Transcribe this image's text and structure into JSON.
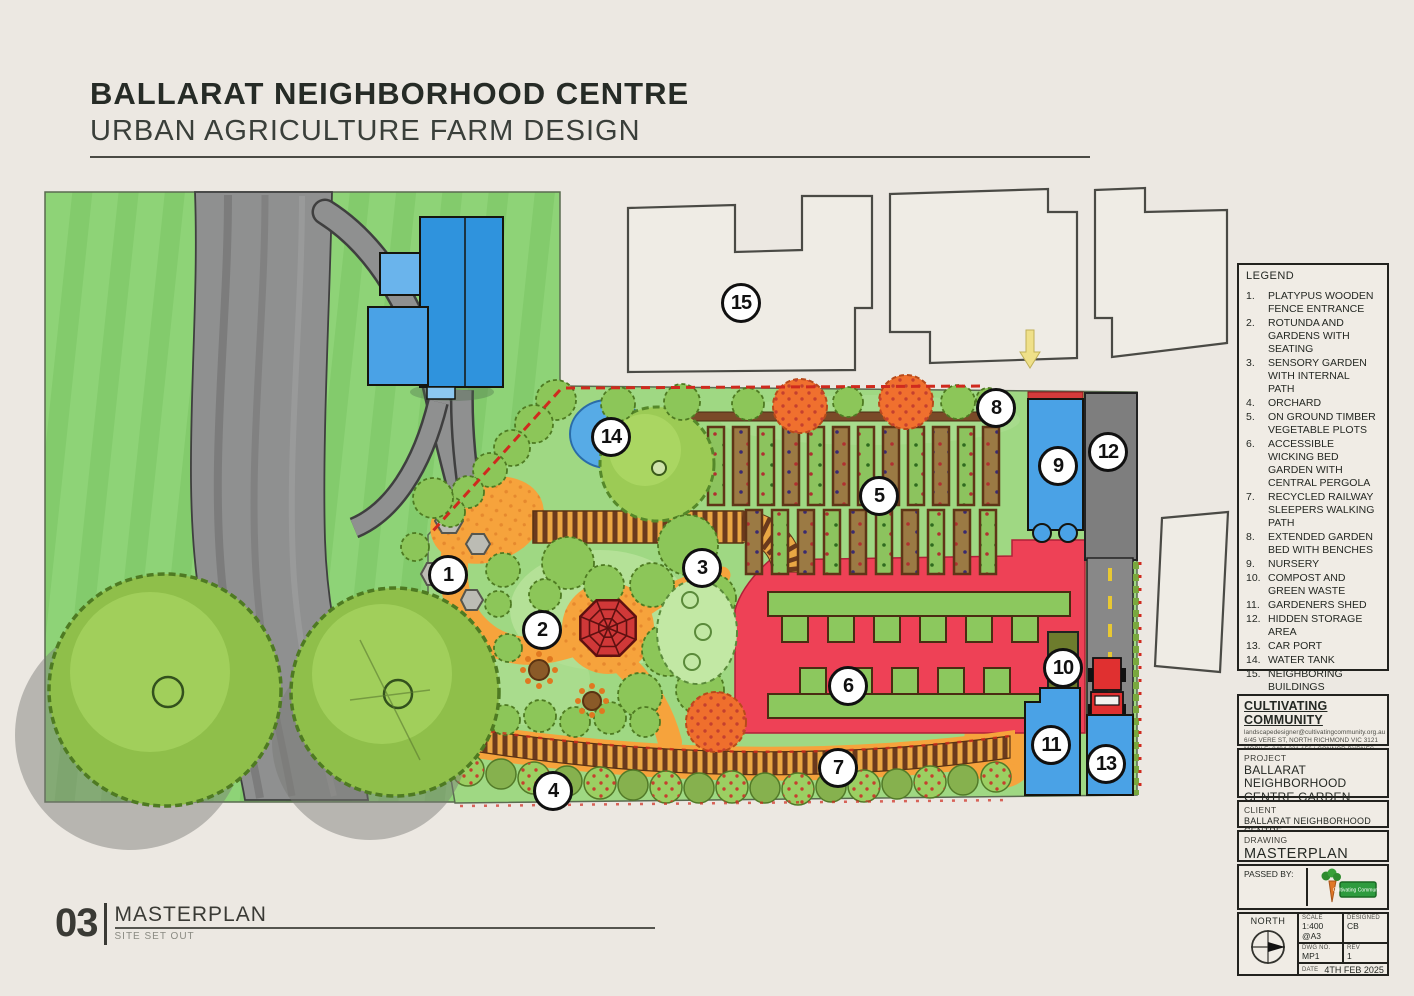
{
  "header": {
    "title_line1": "BALLARAT NEIGHBORHOOD CENTRE",
    "title_line2": "URBAN AGRICULTURE FARM DESIGN"
  },
  "drawing_label": {
    "number": "03",
    "title": "MASTERPLAN",
    "subtitle": "SITE SET OUT"
  },
  "legend": {
    "title": "LEGEND",
    "items": [
      {
        "num": "1.",
        "text": "PLATYPUS WOODEN FENCE ENTRANCE"
      },
      {
        "num": "2.",
        "text": "ROTUNDA AND GARDENS WITH SEATING"
      },
      {
        "num": "3.",
        "text": "SENSORY GARDEN WITH INTERNAL PATH"
      },
      {
        "num": "4.",
        "text": "ORCHARD"
      },
      {
        "num": "5.",
        "text": "ON GROUND TIMBER VEGETABLE PLOTS"
      },
      {
        "num": "6.",
        "text": "ACCESSIBLE WICKING BED GARDEN WITH CENTRAL PERGOLA"
      },
      {
        "num": "7.",
        "text": "RECYCLED RAILWAY SLEEPERS WALKING PATH"
      },
      {
        "num": "8.",
        "text": "EXTENDED GARDEN BED WITH BENCHES"
      },
      {
        "num": "9.",
        "text": "NURSERY"
      },
      {
        "num": "10.",
        "text": "COMPOST AND GREEN WASTE"
      },
      {
        "num": "11.",
        "text": "GARDENERS SHED"
      },
      {
        "num": "12.",
        "text": "HIDDEN STORAGE AREA"
      },
      {
        "num": "13.",
        "text": "CAR PORT"
      },
      {
        "num": "14.",
        "text": "WATER TANK"
      },
      {
        "num": "15.",
        "text": "NEIGHBORING BUILDINGS"
      }
    ]
  },
  "markers": [
    {
      "number": "1"
    },
    {
      "number": "2"
    },
    {
      "number": "3"
    },
    {
      "number": "4"
    },
    {
      "number": "5"
    },
    {
      "number": "6"
    },
    {
      "number": "7"
    },
    {
      "number": "8"
    },
    {
      "number": "9"
    },
    {
      "number": "10"
    },
    {
      "number": "11"
    },
    {
      "number": "12"
    },
    {
      "number": "13"
    },
    {
      "number": "14"
    },
    {
      "number": "15"
    }
  ],
  "title_block": {
    "company": {
      "name": "CULTIVATING COMMUNITY",
      "email": "landscapedesigner@cultivatingcommunity.org.au",
      "address": "6/45 VERE ST, NORTH RICHMOND VIC 3121",
      "phone": "MOBILE: 0404 221 156 | CONNOR BYRNES"
    },
    "project": {
      "label": "PROJECT",
      "value": "BALLARAT NEIGHBORHOOD CENTRE GARDEN BUILD"
    },
    "client": {
      "label": "CLIENT",
      "value": "BALLARAT NEIGHBORHOOD CENTRE"
    },
    "drawing": {
      "label": "DRAWING",
      "value": "MASTERPLAN"
    },
    "passed_by_label": "PASSED BY:",
    "logo_text": "Cultivating Community",
    "north_label": "NORTH",
    "scale": {
      "label": "SCALE",
      "value": "1:400 @A3"
    },
    "designed": {
      "label": "DESIGNED",
      "value": "CB"
    },
    "dwg_no": {
      "label": "DWG NO.",
      "value": "MP1"
    },
    "rev": {
      "label": "REV",
      "value": "1"
    },
    "date": {
      "label": "DATE",
      "value": "4TH FEB 2025"
    }
  },
  "colors": {
    "paper": "#ece8e2",
    "lawn_green": "#8ed377",
    "garden_green": "#9fd883",
    "road_grey": "#8f9090",
    "path_orange": "#f6a33c",
    "wicking_red": "#ee4156",
    "water_blue": "#4aa2e6",
    "fence_red": "#cf2a1e",
    "sleeper_brown": "#6b3a1d"
  }
}
